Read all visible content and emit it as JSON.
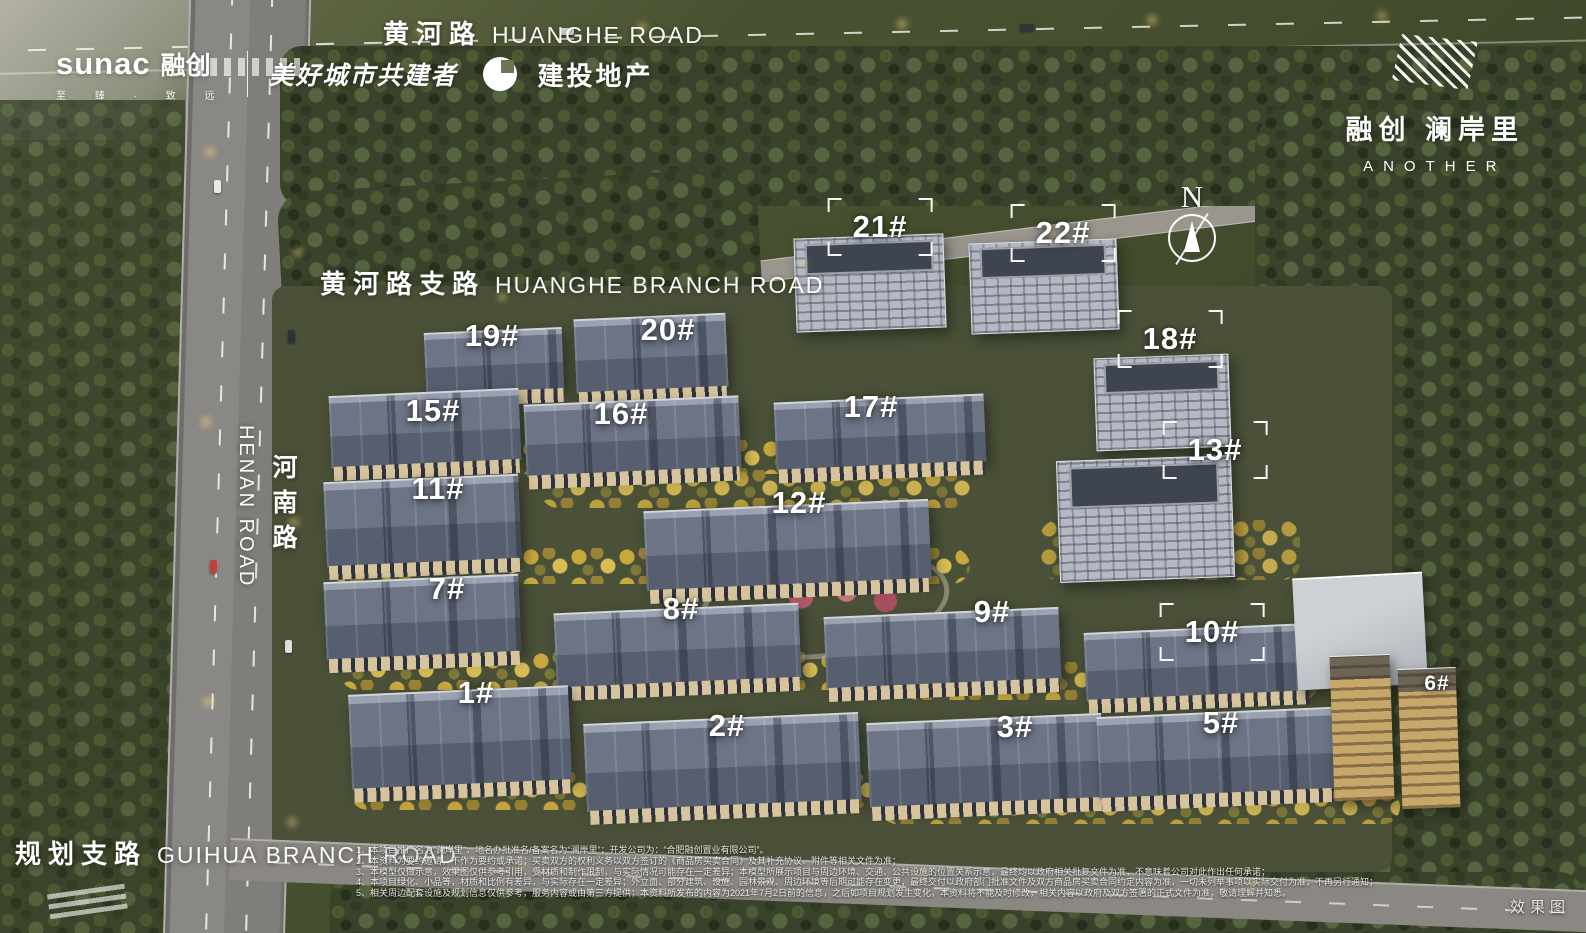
{
  "branding": {
    "developer_latin": "sunac",
    "developer_zh": "融创",
    "developer_tagline": "至 臻 · 致 远",
    "slogan": "美好城市共建者",
    "partner": "建投地产"
  },
  "project": {
    "name_zh": "融创 澜岸里",
    "name_en": "ANOTHER"
  },
  "compass": {
    "north": "N"
  },
  "roads": {
    "huanghe": {
      "zh": "黄河路",
      "en": "HUANGHE ROAD"
    },
    "huanghe_branch": {
      "zh": "黄河路支路",
      "en": "HUANGHE BRANCH ROAD"
    },
    "henan": {
      "zh": "河南路",
      "en": "HENAN ROAD"
    },
    "guihua_branch": {
      "zh": "规划支路",
      "en": "GUIHUA BRANCH ROAD"
    }
  },
  "buildings": [
    {
      "label": "21#",
      "x": 880,
      "y": 227,
      "bracket": true,
      "small": false
    },
    {
      "label": "22#",
      "x": 1063,
      "y": 233,
      "bracket": true,
      "small": false
    },
    {
      "label": "19#",
      "x": 492,
      "y": 336,
      "bracket": false,
      "small": false
    },
    {
      "label": "20#",
      "x": 668,
      "y": 330,
      "bracket": false,
      "small": false
    },
    {
      "label": "18#",
      "x": 1170,
      "y": 339,
      "bracket": true,
      "small": false
    },
    {
      "label": "15#",
      "x": 433,
      "y": 411,
      "bracket": false,
      "small": false
    },
    {
      "label": "16#",
      "x": 621,
      "y": 414,
      "bracket": false,
      "small": false
    },
    {
      "label": "17#",
      "x": 871,
      "y": 407,
      "bracket": false,
      "small": false
    },
    {
      "label": "13#",
      "x": 1215,
      "y": 450,
      "bracket": true,
      "small": false
    },
    {
      "label": "11#",
      "x": 438,
      "y": 489,
      "bracket": false,
      "small": false
    },
    {
      "label": "12#",
      "x": 799,
      "y": 503,
      "bracket": false,
      "small": false
    },
    {
      "label": "7#",
      "x": 447,
      "y": 589,
      "bracket": false,
      "small": false
    },
    {
      "label": "8#",
      "x": 681,
      "y": 609,
      "bracket": false,
      "small": false
    },
    {
      "label": "9#",
      "x": 992,
      "y": 612,
      "bracket": false,
      "small": false
    },
    {
      "label": "10#",
      "x": 1212,
      "y": 632,
      "bracket": true,
      "small": false
    },
    {
      "label": "1#",
      "x": 476,
      "y": 693,
      "bracket": false,
      "small": false
    },
    {
      "label": "2#",
      "x": 727,
      "y": 726,
      "bracket": false,
      "small": false
    },
    {
      "label": "3#",
      "x": 1015,
      "y": 727,
      "bracket": false,
      "small": false
    },
    {
      "label": "5#",
      "x": 1221,
      "y": 723,
      "bracket": false,
      "small": false
    },
    {
      "label": "6#",
      "x": 1437,
      "y": 684,
      "bracket": false,
      "small": true
    }
  ],
  "footer": {
    "disclaimer_lines": [
      "1、本项目推广名为“澜岸里”，地名办批准名/备案名为“澜岸里”；开发公司为：“合肥融创置业有限公司”。",
      "2、本资料为要约邀请，不作为要约或承诺；买卖双方的权利义务以双方签订的《商品房买卖合同》及其补充协议、附件等相关文件为准；",
      "3、本模型仅做示意，效果图仅供参考引用，受材质和制作限制，与实际情况可能存在一定差异；本模型所展示项目与周边环境、交通、公共设施的位置关系示意，最终均以政府相关批复文件为准，不意味着公司对此作出任何承诺；",
      "4、本项目绿化、小品等，材质和比例有差异，与实际存在一定差异；外立面、部分建筑、设施、园林景观、周边环境等后期可能存在变更，最终交付以政府部门批准文件及双方商品房买卖合同约定内容为准，一切未列举事项以实际交付为准，不再另行通知；",
      "5、相关周边配套设施及规划信息仅供参考，服务内容或由第三方提供；本资料所发布的内容为2021年7月2日前的信息，之后如项目规划发生变化，本资料将不能及时修改，相关内容以政府及双方签署的正式文件为准，敬请理解并知悉。"
    ],
    "render_note": "效果图"
  }
}
